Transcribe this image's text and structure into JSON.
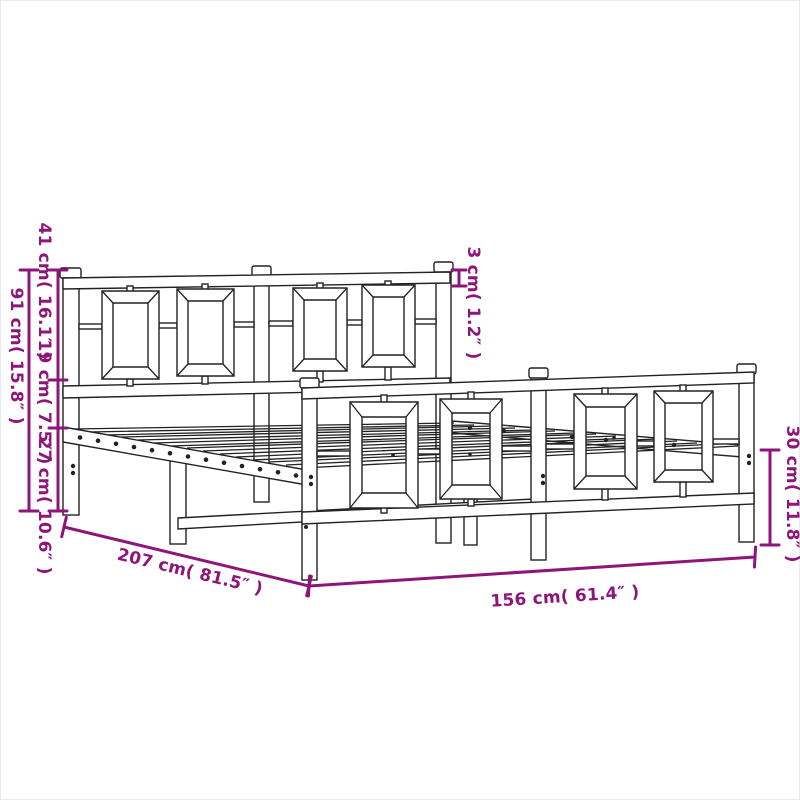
{
  "meta": {
    "subject": "Dimension diagram of a metal bed frame with headboard and footboard"
  },
  "colors": {
    "background": "#ffffff",
    "image_border": "#ebebeb",
    "line_art": "#222222",
    "dimension_annotation": "#8E1579"
  },
  "dimension_labels": {
    "headboard_upper": "41 cm( 16.1″ )",
    "headboard_middle": "19 cm( 7.5″ )",
    "headboard_lower": "27 cm( 10.6″ )",
    "headboard_total": "91 cm( 15.8″ )",
    "tube_thickness": "3 cm( 1.2″ )",
    "underbed_clearance": "30 cm( 11.8″ )",
    "frame_length": "207 cm( 81.5″ )",
    "frame_width": "156 cm( 61.4″ )"
  }
}
